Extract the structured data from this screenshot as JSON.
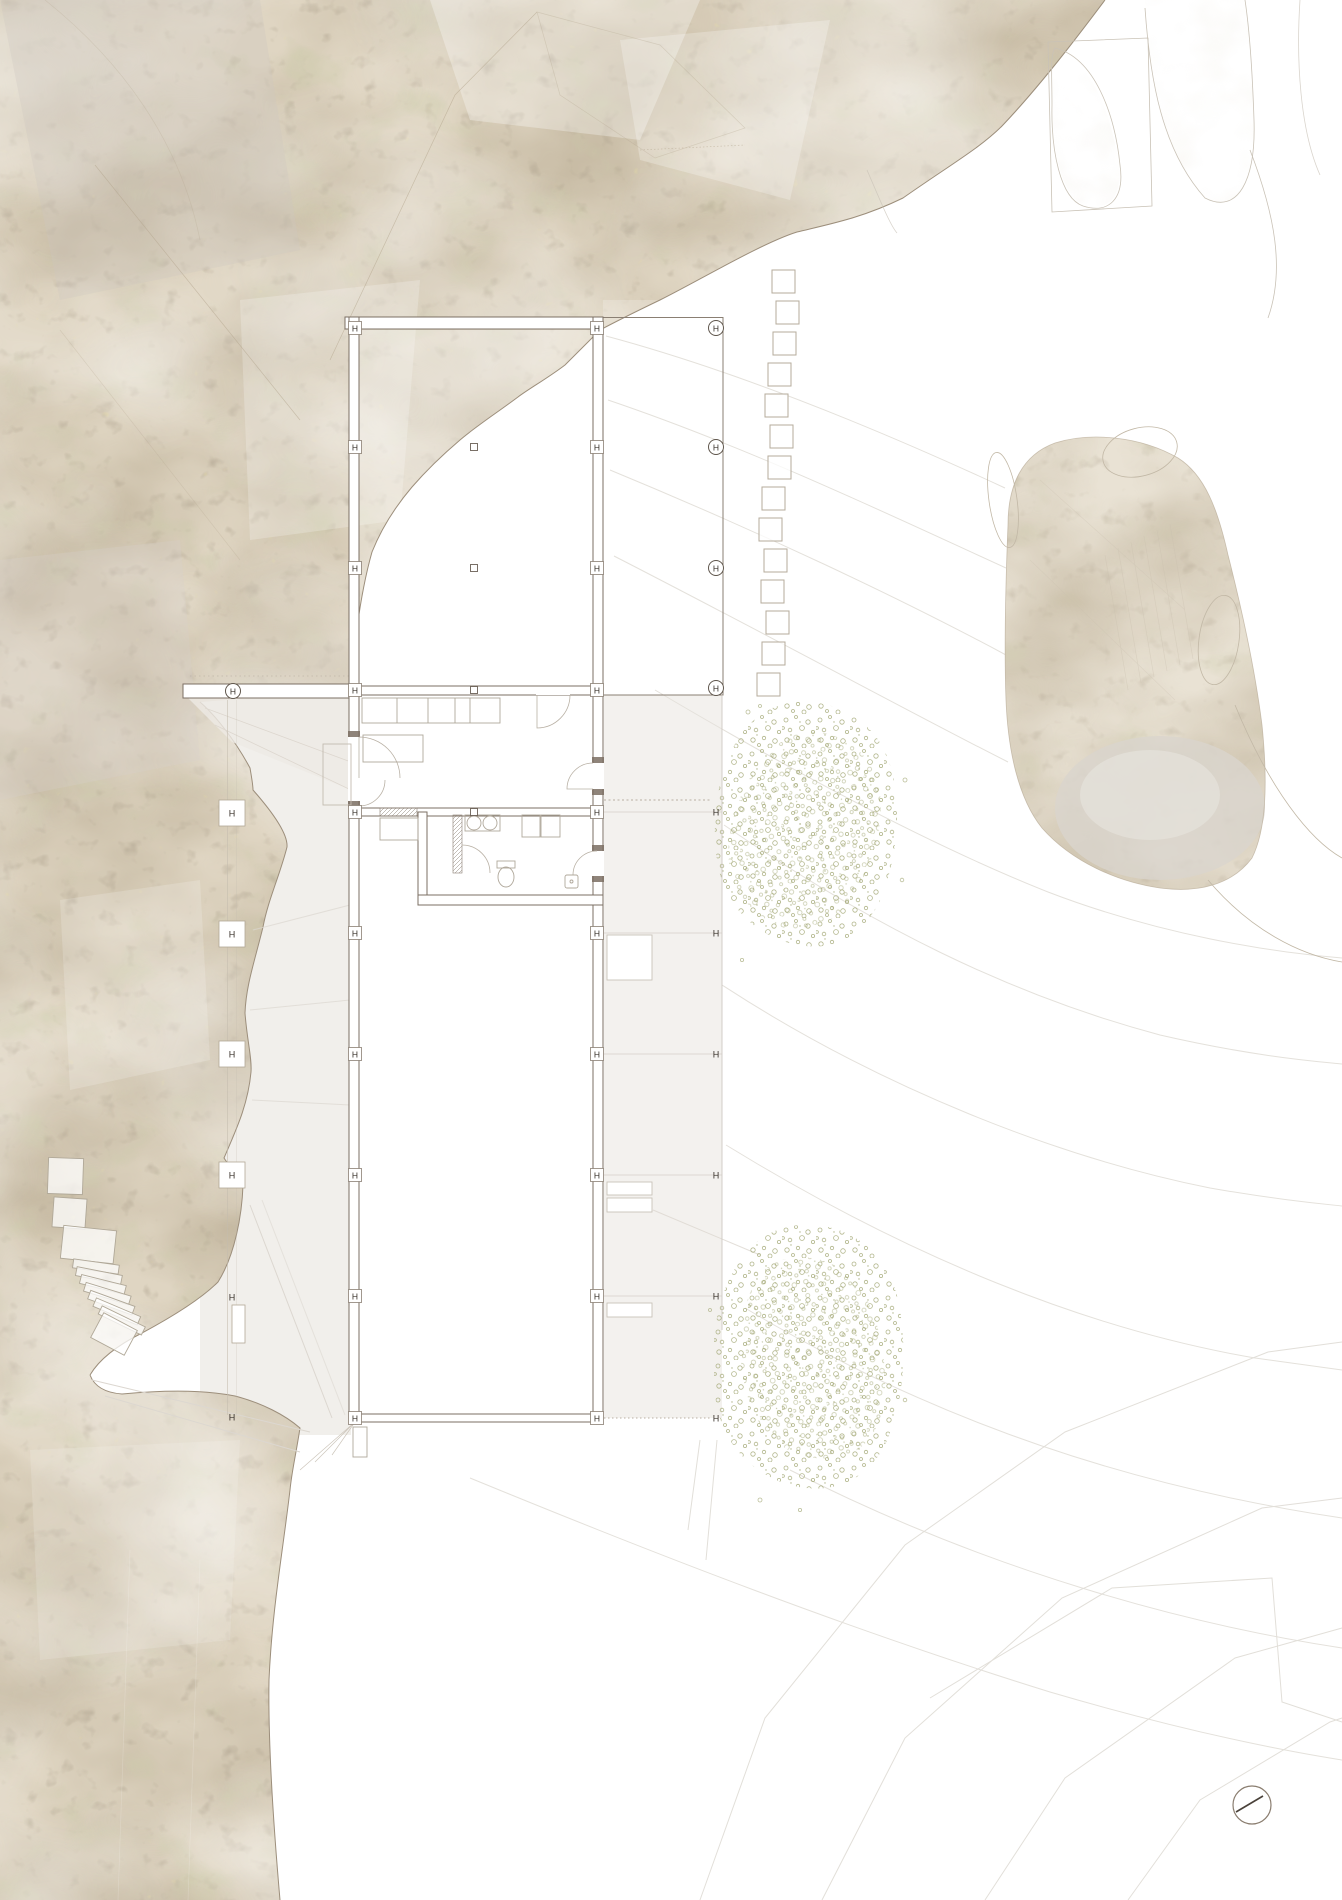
{
  "plan": {
    "column_marker_label": "H",
    "column_rows_y": [
      328,
      447,
      568,
      690,
      812,
      933,
      1054,
      1175,
      1296,
      1418
    ],
    "wall_marker_xs": [
      355,
      597
    ],
    "colonnade_x": 716,
    "colonnade_circled_rows": [
      328,
      447,
      568,
      688
    ],
    "colonnade_plain_rows": [
      812,
      933,
      1054,
      1175,
      1296,
      1418
    ],
    "left_pad_line": {
      "x": 232,
      "pad_rows": [
        813,
        934,
        1054,
        1175
      ],
      "plain_rows": [
        1297,
        1417
      ],
      "bar_marker": {
        "x": 233,
        "y": 691
      }
    },
    "center_dot_line": {
      "x": 474,
      "rows": [
        447,
        568,
        690,
        812
      ]
    },
    "stepping_stones": {
      "count": 14,
      "size": 23,
      "y_first": 270,
      "y_step": 31,
      "xs": [
        772,
        776,
        773,
        768,
        765,
        770,
        768,
        762,
        759,
        764,
        761,
        766,
        762,
        757
      ]
    }
  },
  "landscape": {
    "tree_count": 2,
    "compass": {
      "cx": 1252,
      "cy": 1805,
      "r": 19
    }
  },
  "colors": {
    "paper": "#ffffff",
    "terrain_base": "#dfd5c2",
    "terrain_brown": "#8b7858",
    "terrain_olive": "#9aa06a",
    "plan_line": "#7b6f63",
    "marker_ink": "#3a332c",
    "contour": "#e4e1db",
    "terrace": "#f3f1ee",
    "stipple_green": "#9fa46f",
    "pad_outline": "#b2a896"
  }
}
